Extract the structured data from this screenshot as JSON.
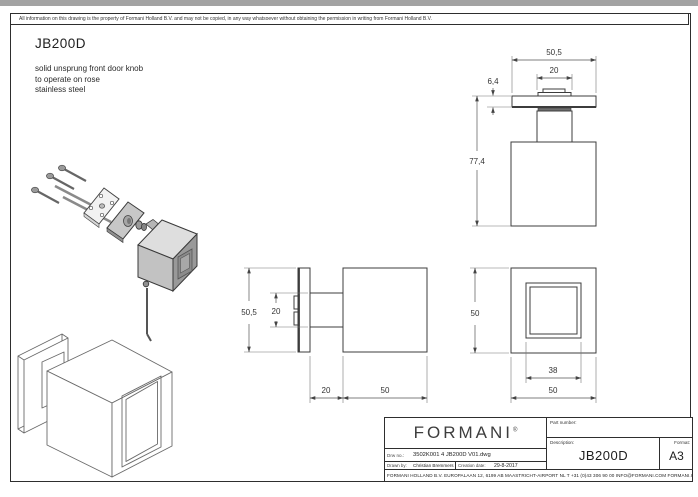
{
  "page": {
    "disclaimer": "All information on this drawing is the property of Formani Holland B.V. and may not be copied, in any way whatsoever without obtaining the permission in writing from Formani Holland B.V.",
    "title": "JB200D",
    "description_lines": [
      "solid unsprung front door knob",
      "to operate on rose",
      "stainless steel"
    ]
  },
  "dimensions": {
    "top_view": {
      "rose_width": "50,5",
      "neck_width": "20",
      "rose_thickness": "6,4",
      "total_height": "77,4"
    },
    "side_view": {
      "rose_height": "50,5",
      "neck_height": "20",
      "projection": "20",
      "knob_depth": "50"
    },
    "front_view": {
      "knob_height": "50",
      "inner_square": "38",
      "knob_width": "50"
    }
  },
  "title_block": {
    "brand": "FORMANI",
    "brand_mark": "®",
    "part_number_label": "Part number:",
    "description_label": "Description:",
    "description_value": "JB200D",
    "format_label": "Format:",
    "format_value": "A3",
    "drw_no_label": "Drw no.:",
    "drw_no_value": "3502K001 4 JB200D V01.dwg",
    "drawn_by_label": "Drawn by:",
    "drawn_by_value": "Christian Bremmers",
    "creation_date_label": "Creation date:",
    "creation_date_value": "29-8-2017",
    "address": "FORMANI HOLLAND B.V.   EUROPALAAN 12, 6199 AB MAASTRICHT-AIRPORT NL   T +31 (0)43 306 90 00   INFO@FORMANI.COM   FORMANI.COM"
  }
}
